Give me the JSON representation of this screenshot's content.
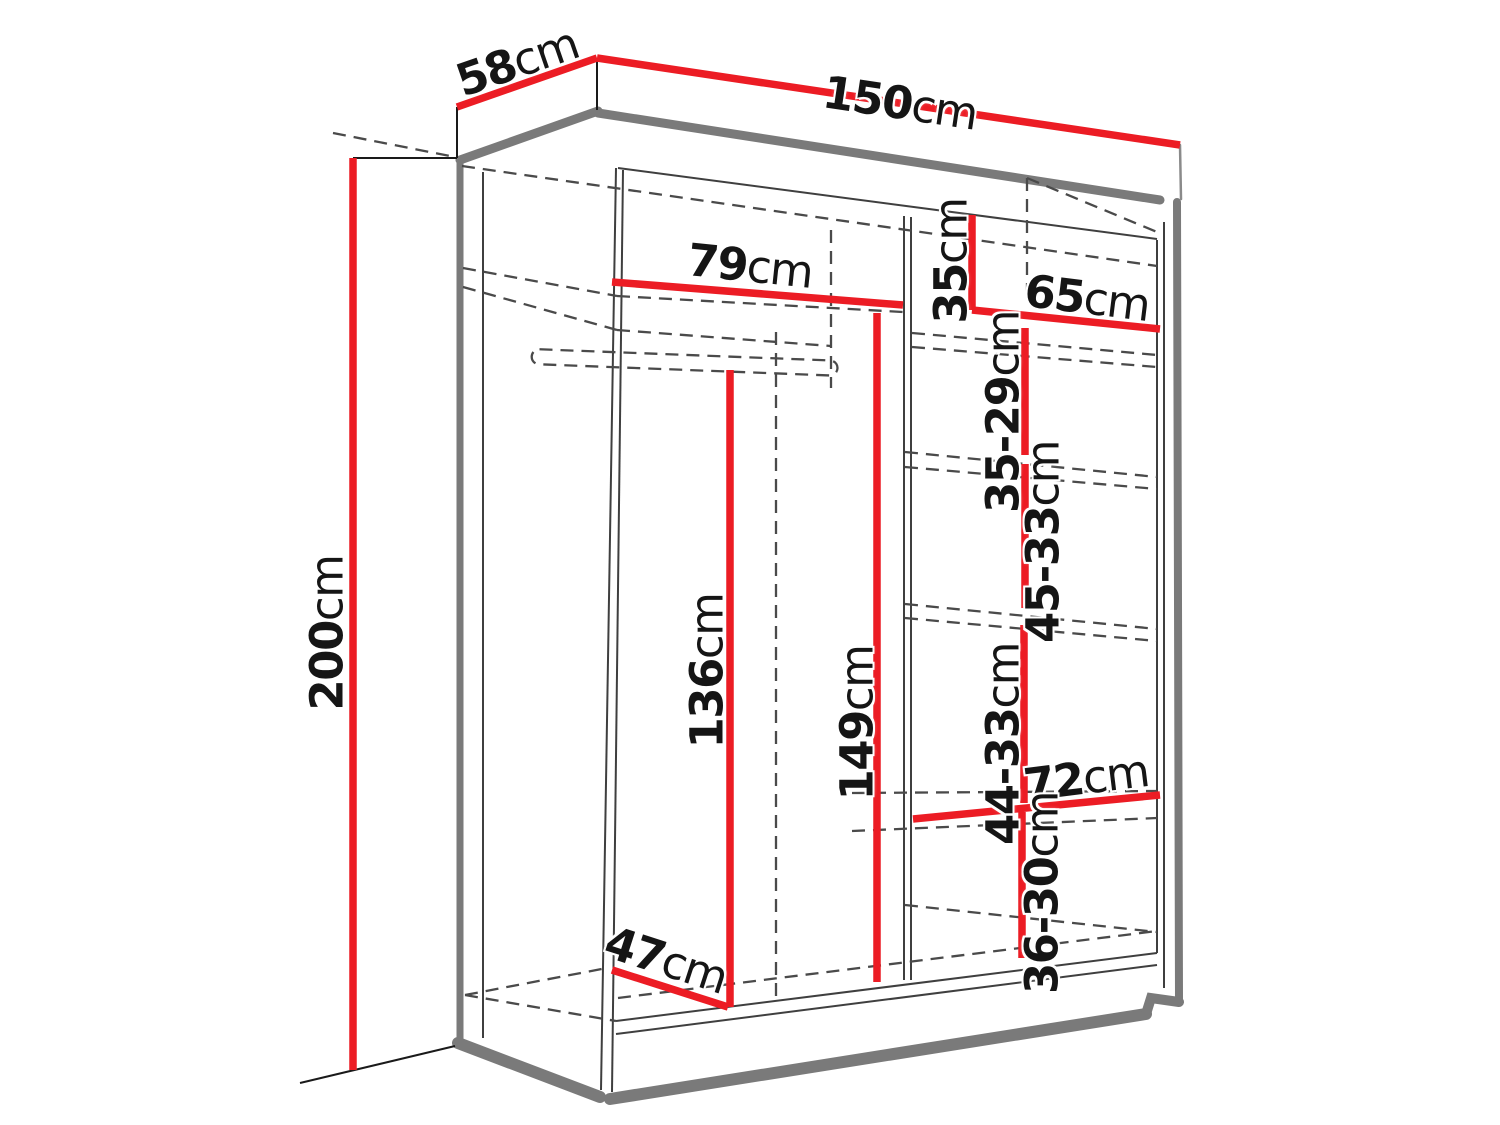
{
  "diagram": {
    "title": "wardrobe-dimension-diagram",
    "unit_system": "cm",
    "accent_color": "#ec1c24",
    "outline_color": "#7a7a7a",
    "dimensions": {
      "total_width": {
        "value": "150",
        "unit": "cm"
      },
      "total_depth": {
        "value": "58",
        "unit": "cm"
      },
      "total_height": {
        "value": "200",
        "unit": "cm"
      },
      "left_section_width": {
        "value": "79",
        "unit": "cm"
      },
      "top_shelf_height": {
        "value": "35",
        "unit": "cm"
      },
      "right_section_width": {
        "value": "65",
        "unit": "cm"
      },
      "shelf_gap_1": {
        "value": "35-29",
        "unit": "cm"
      },
      "shelf_gap_2": {
        "value": "45-33",
        "unit": "cm"
      },
      "hanging_height": {
        "value": "136",
        "unit": "cm"
      },
      "middle_height": {
        "value": "149",
        "unit": "cm"
      },
      "shelf_gap_3": {
        "value": "44-33",
        "unit": "cm"
      },
      "bottom_right_width": {
        "value": "72",
        "unit": "cm"
      },
      "shelf_gap_4": {
        "value": "36-30",
        "unit": "cm"
      },
      "interior_depth": {
        "value": "47",
        "unit": "cm"
      }
    }
  }
}
